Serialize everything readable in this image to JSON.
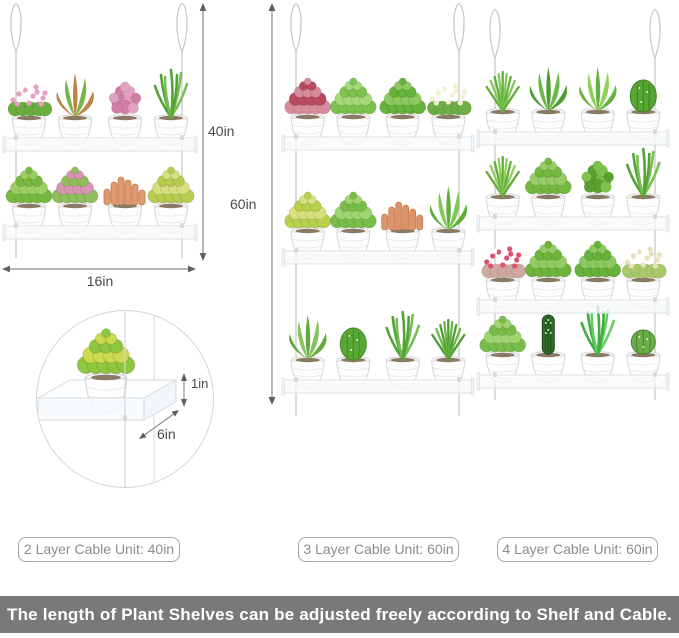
{
  "canvas": {
    "bg": "#ffffff"
  },
  "dimensions": {
    "unit_a_height": "40in",
    "unit_a_width": "16in",
    "unit_b_height": "60in",
    "shelf_lip": "1in",
    "shelf_depth": "6in"
  },
  "unit_labels": [
    {
      "text": "2 Layer Cable Unit: 40in"
    },
    {
      "text": "3 Layer Cable Unit: 60in"
    },
    {
      "text": "4 Layer Cable Unit: 60in"
    }
  ],
  "banner": {
    "text": "The length of Plant Shelves can be adjusted freely according to Shelf and Cable.",
    "bg": "#797979",
    "color": "#ffffff"
  },
  "palette": {
    "cable": "#c9c9c9",
    "shelf_edge": "#dde2e5",
    "shelf_fill": "rgba(246,249,251,0.78)",
    "arrow_line": "#8a8a8a",
    "arrow_head": "#5f5f5f",
    "dim_text": "#4a4a4a",
    "pot_body": "#fdfdfd",
    "pot_edge": "#d6d6d6"
  },
  "detail": {
    "plant": {
      "t": "rosette",
      "c": "#8fc63f",
      "a": "#cdd94e"
    }
  },
  "units": [
    {
      "name": "two-layer-unit",
      "layers": 2,
      "x": 4,
      "w": 192,
      "cables": [
        16,
        182
      ],
      "loop_top": 2,
      "cable_end": 258,
      "shelves": [
        138,
        226
      ],
      "rows": [
        [
          {
            "t": "flower",
            "c": "#69ae3e",
            "a": "#e8a0c0"
          },
          {
            "t": "aloe",
            "c": "#bf8348",
            "a": "#79b545"
          },
          {
            "t": "moss",
            "c": "#e3a2bf",
            "a": "#d17ea4"
          },
          {
            "t": "grass",
            "c": "#55a235",
            "a": "#79c052"
          }
        ],
        [
          {
            "t": "rosette",
            "c": "#76b93f",
            "a": "#9ccf63"
          },
          {
            "t": "rosette",
            "c": "#8fbf5a",
            "a": "#d795b2"
          },
          {
            "t": "coral",
            "c": "#e09a72",
            "a": "#c97a4e"
          },
          {
            "t": "rosette",
            "c": "#b7cc4e",
            "a": "#d4e07e"
          }
        ]
      ]
    },
    {
      "name": "three-layer-unit",
      "layers": 3,
      "x": 283,
      "w": 190,
      "cables": [
        296,
        459
      ],
      "loop_top": 2,
      "cable_end": 416,
      "shelves": [
        137,
        251,
        380
      ],
      "rows": [
        [
          {
            "t": "rosette",
            "c": "#d98b9e",
            "a": "#b84a5e"
          },
          {
            "t": "rosette",
            "c": "#7cc24e",
            "a": "#a4d878"
          },
          {
            "t": "rosette",
            "c": "#67b23a",
            "a": "#8cc95e"
          },
          {
            "t": "flower",
            "c": "#6fae45",
            "a": "#f3efd4"
          }
        ],
        [
          {
            "t": "rosette",
            "c": "#b9cf4e",
            "a": "#d7e07c"
          },
          {
            "t": "rosette",
            "c": "#79bd49",
            "a": "#a0d470"
          },
          {
            "t": "coral",
            "c": "#dd9468",
            "a": "#c97a4e"
          },
          {
            "t": "aloe",
            "c": "#5fae3a",
            "a": "#7cc855"
          }
        ],
        [
          {
            "t": "aloe",
            "c": "#63a93c",
            "a": "#86c260"
          },
          {
            "t": "cactus",
            "c": "#59a834",
            "a": "#3f8c23"
          },
          {
            "t": "grass",
            "c": "#54a335",
            "a": "#76bd52"
          },
          {
            "t": "pine",
            "c": "#4f9e33",
            "a": "#6db84a"
          }
        ]
      ]
    },
    {
      "name": "four-layer-unit",
      "layers": 4,
      "x": 478,
      "w": 190,
      "cables": [
        495,
        655
      ],
      "loop_top": 8,
      "cable_end": 400,
      "shelves": [
        132,
        217,
        300,
        375
      ],
      "rows": [
        [
          {
            "t": "pine",
            "c": "#5fae3a",
            "a": "#83c65d"
          },
          {
            "t": "aloe",
            "c": "#4f9e33",
            "a": "#6db84a"
          },
          {
            "t": "aloe",
            "c": "#66b240",
            "a": "#8fd05a"
          },
          {
            "t": "cactus",
            "c": "#57a634",
            "a": "#417f1f"
          }
        ],
        [
          {
            "t": "pine",
            "c": "#63a93c",
            "a": "#8fd05a"
          },
          {
            "t": "rosette",
            "c": "#74b83f",
            "a": "#98cc66"
          },
          {
            "t": "moss",
            "c": "#7cc24e",
            "a": "#5aa02e"
          },
          {
            "t": "grass",
            "c": "#54a335",
            "a": "#79c052"
          }
        ],
        [
          {
            "t": "flower",
            "c": "#cfa89e",
            "a": "#d9536e"
          },
          {
            "t": "rosette",
            "c": "#6fb53c",
            "a": "#93cc62"
          },
          {
            "t": "rosette",
            "c": "#67b23a",
            "a": "#8cc95e"
          },
          {
            "t": "flower",
            "c": "#a8c86a",
            "a": "#eadfb9"
          }
        ],
        [
          {
            "t": "rosette",
            "c": "#79bd49",
            "a": "#a0d470"
          },
          {
            "t": "column",
            "c": "#2f6b2a",
            "a": "#1c4a18"
          },
          {
            "t": "grass",
            "c": "#3fae3f",
            "a": "#63cf63"
          },
          {
            "t": "ball",
            "c": "#6ab04a",
            "a": "#47862c"
          }
        ]
      ]
    }
  ]
}
